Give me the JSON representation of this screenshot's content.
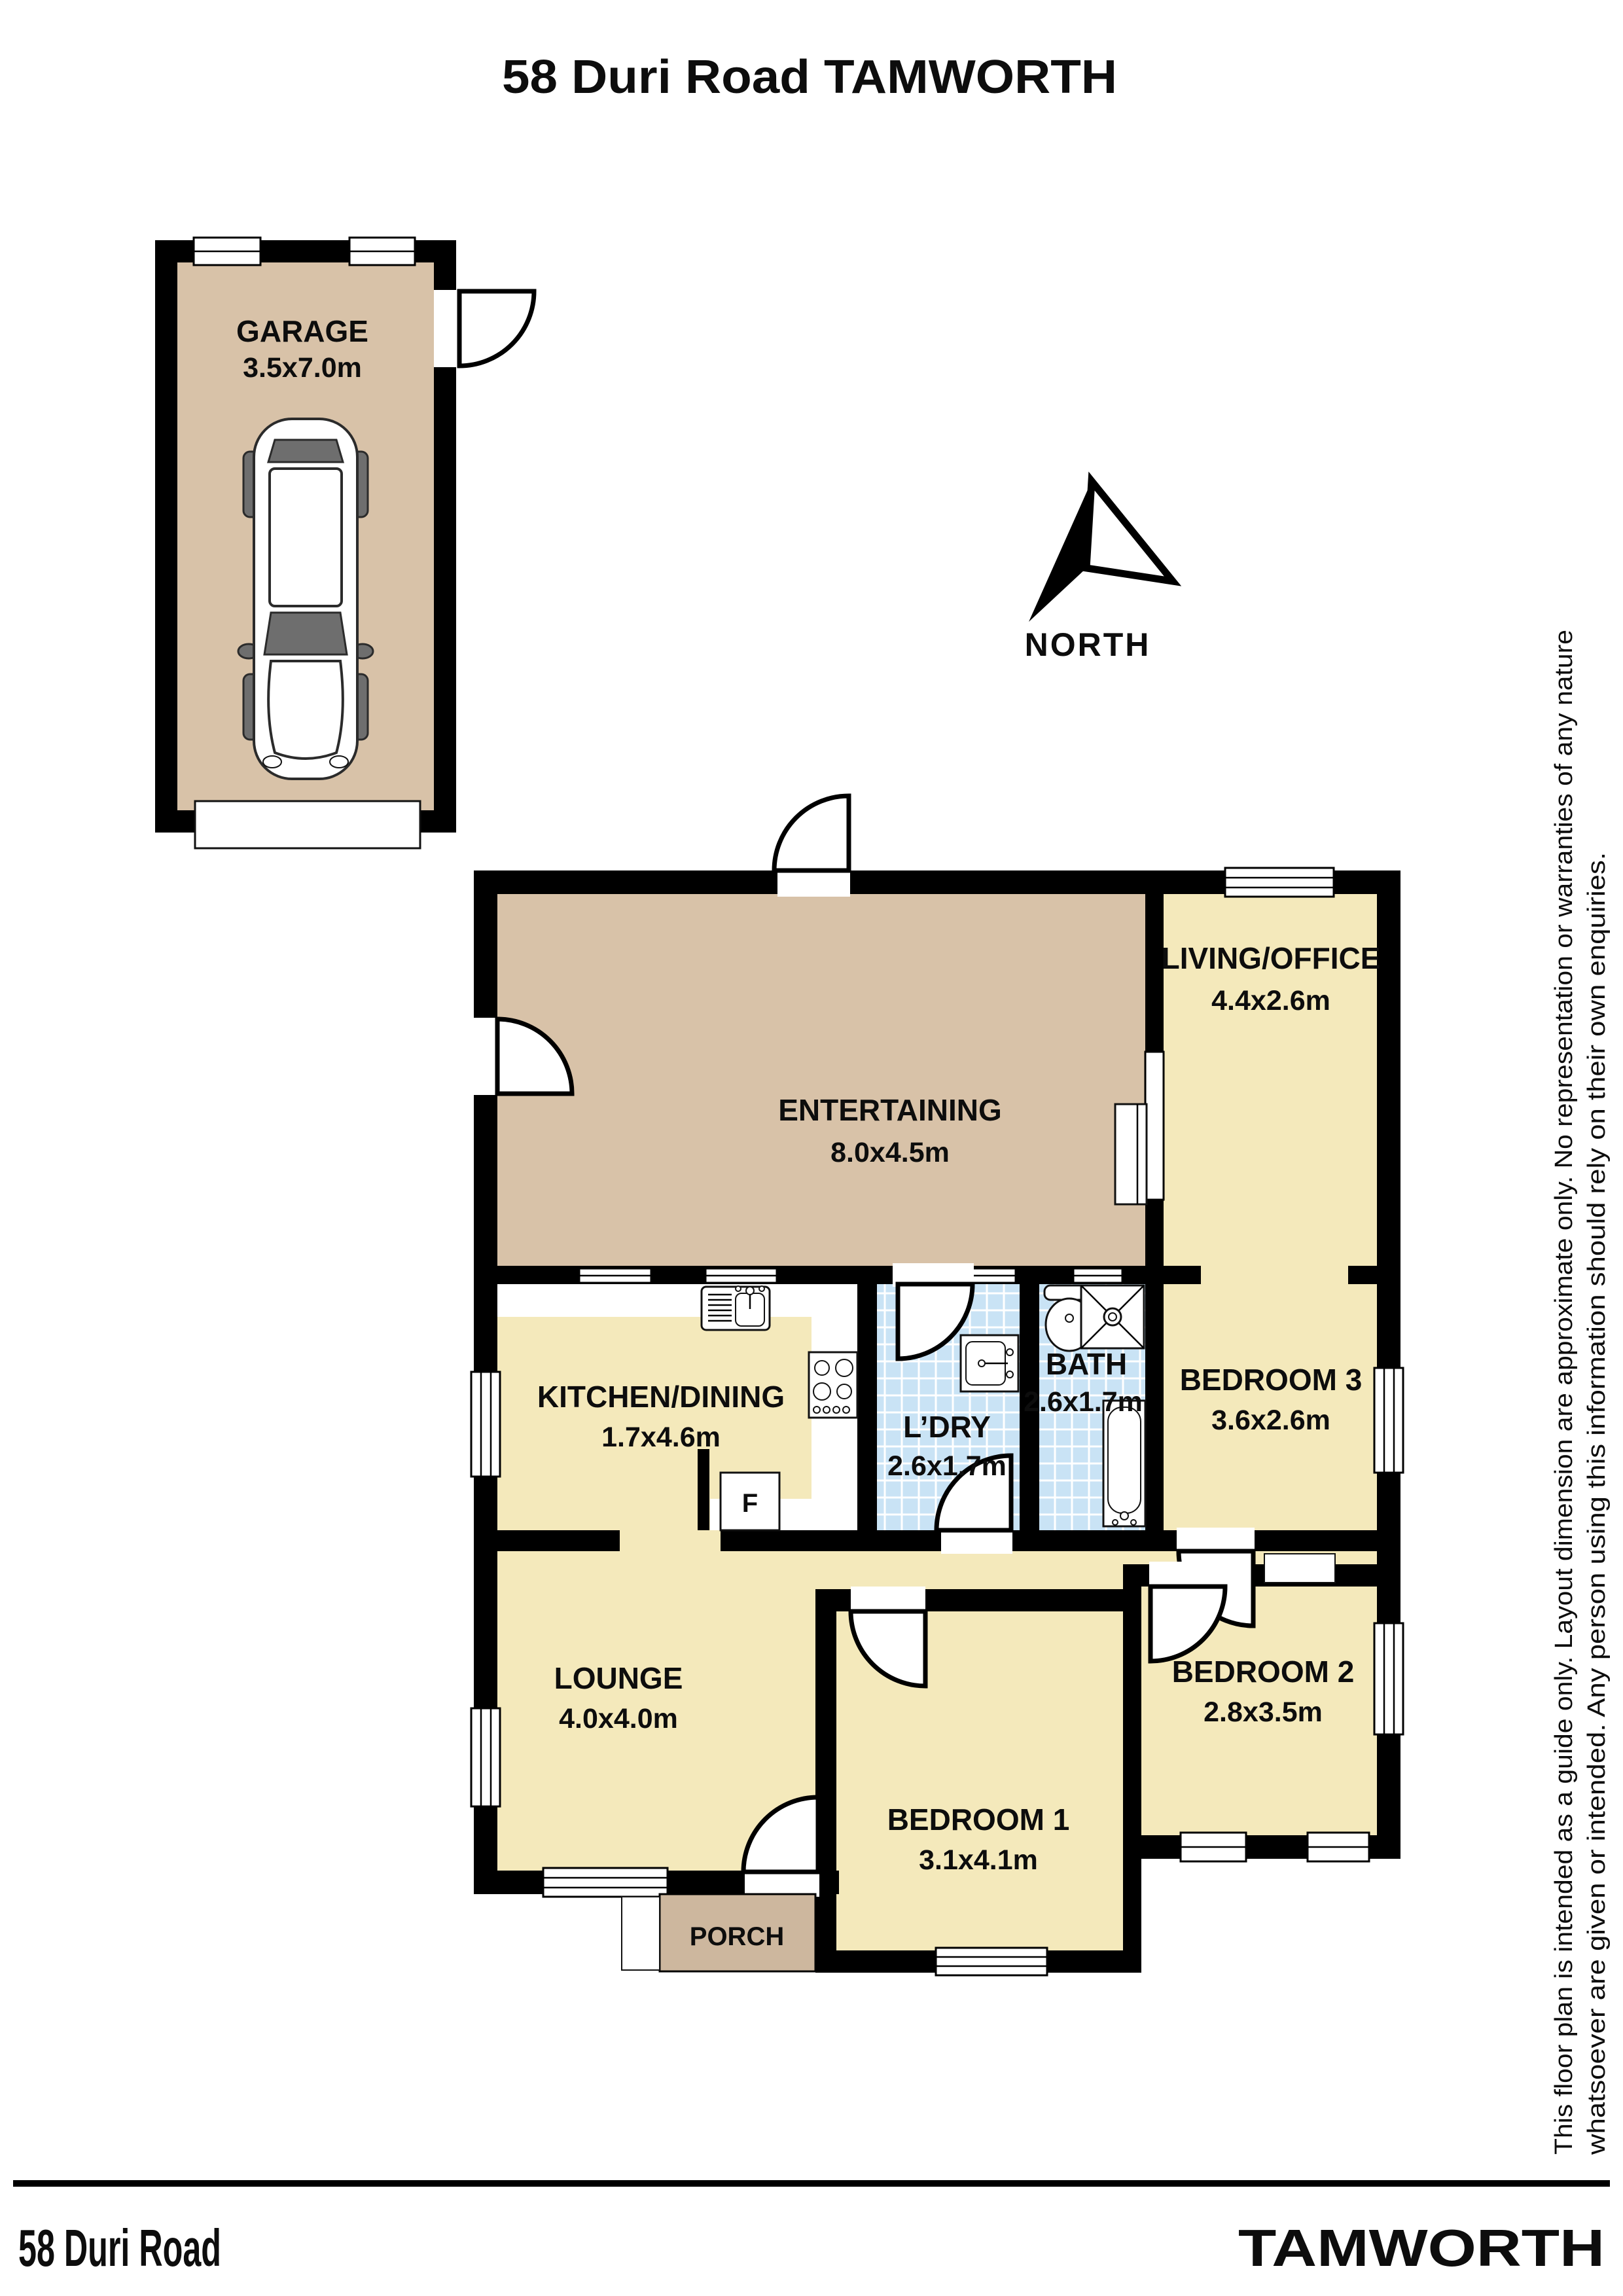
{
  "title": "58 Duri Road TAMWORTH",
  "north_label": "NORTH",
  "rooms": {
    "garage": {
      "name": "GARAGE",
      "dims": "3.5x7.0m"
    },
    "entertaining": {
      "name": "ENTERTAINING",
      "dims": "8.0x4.5m"
    },
    "living_office": {
      "name": "LIVING/OFFICE",
      "dims": "4.4x2.6m"
    },
    "kitchen_dining": {
      "name": "KITCHEN/DINING",
      "dims": "1.7x4.6m"
    },
    "laundry": {
      "name": "L’DRY",
      "dims": "2.6x1.7m"
    },
    "bath": {
      "name": "BATH",
      "dims": "2.6x1.7m"
    },
    "bedroom3": {
      "name": "BEDROOM 3",
      "dims": "3.6x2.6m"
    },
    "lounge": {
      "name": "LOUNGE",
      "dims": "4.0x4.0m"
    },
    "bedroom1": {
      "name": "BEDROOM 1",
      "dims": "3.1x4.1m"
    },
    "bedroom2": {
      "name": "BEDROOM 2",
      "dims": "2.8x3.5m"
    },
    "porch": {
      "name": "PORCH"
    }
  },
  "fixtures": {
    "fridge_label": "F"
  },
  "footer": {
    "left": "58 Duri Road",
    "right": "TAMWORTH"
  },
  "disclaimer": {
    "line1": "This floor plan is intended as a guide only. Layout dimension are approximate only. No representation or warranties of any nature",
    "line2": "whatsoever are given or intended. Any person using this information should rely on their own enquiries."
  },
  "palette": {
    "wall": "#000000",
    "tan": "#d8c2a8",
    "yellow": "#f4e9bb",
    "porch": "#cdb79e",
    "tile": "#c9e3f5"
  }
}
